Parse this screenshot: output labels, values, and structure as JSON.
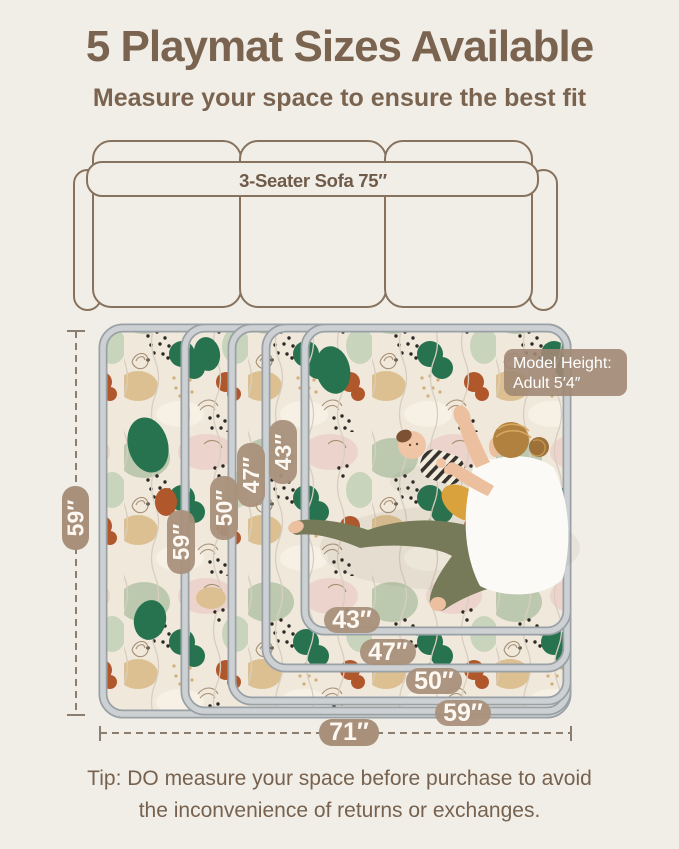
{
  "header": {
    "title": "5 Playmat Sizes Available",
    "subtitle": "Measure your space to ensure the best fit"
  },
  "sofa": {
    "label": "3-Seater Sofa 75″"
  },
  "playmat": {
    "outer_height_label": "59″",
    "outer_width_label": "71″",
    "side_labels": [
      "59″",
      "50″",
      "47″",
      "43″"
    ],
    "bottom_labels": [
      "43″",
      "47″",
      "50″",
      "59″"
    ],
    "sizes": [
      "43″",
      "47″",
      "50″",
      "59″",
      "71″"
    ],
    "model_badge": {
      "line1": "Model Height:",
      "line2": "Adult  5′4″"
    }
  },
  "footer": {
    "tip_line1": "Tip: DO measure your space before purchase to avoid",
    "tip_line2": "the inconvenience of returns or exchanges."
  },
  "colors": {
    "background": "#f1eee7",
    "heading_brown": "#7a6450",
    "badge_tan": "#a9907b",
    "sofa_outline": "#87725d",
    "mat_binding_gray": "#cdd1d3",
    "dimension_line": "#8b7e6e"
  }
}
